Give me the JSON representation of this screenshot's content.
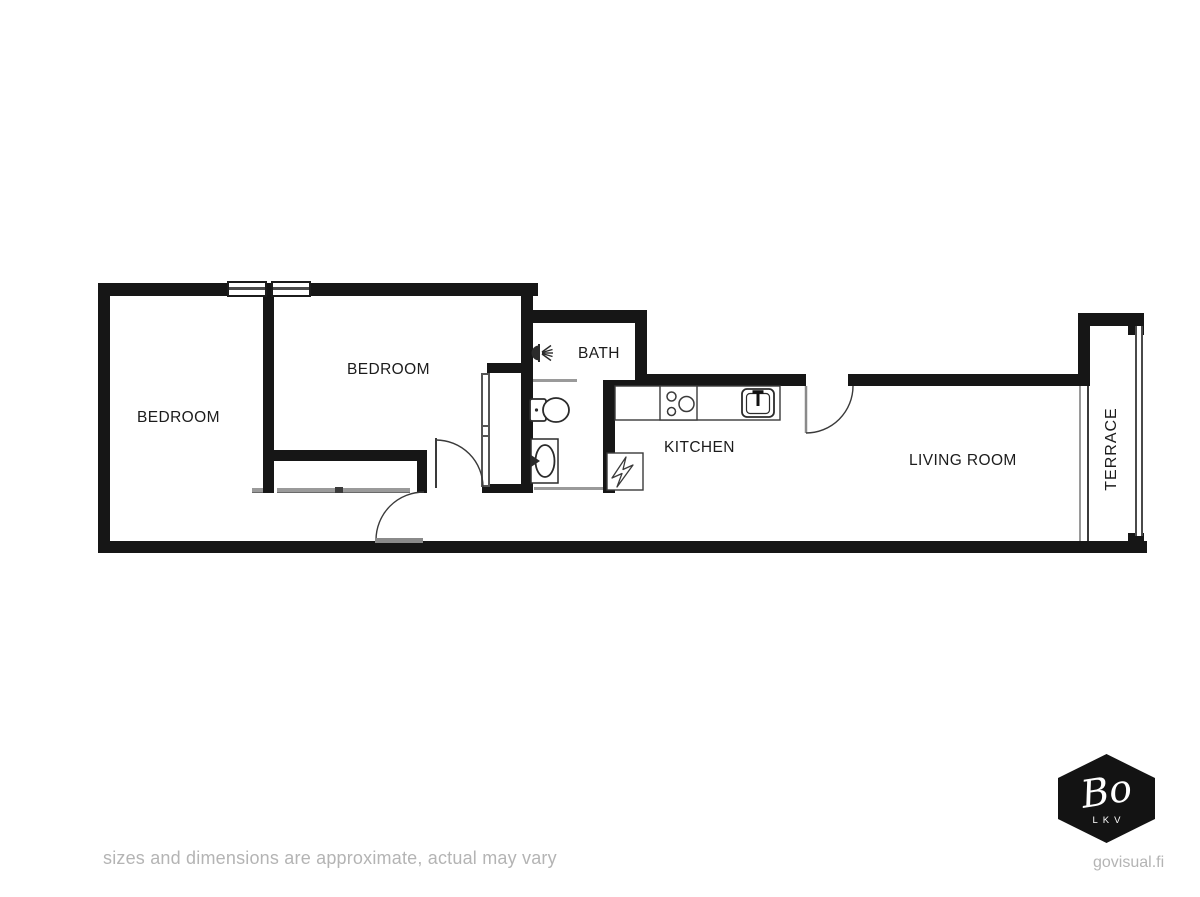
{
  "plan": {
    "rooms": {
      "bedroom1": "BEDROOM",
      "bedroom2": "BEDROOM",
      "bath": "BATH",
      "kitchen": "KITCHEN",
      "living_room": "LIVING ROOM",
      "terrace": "TERRACE"
    },
    "icons": {
      "shower": "shower-head-icon",
      "toilet": "toilet-icon",
      "bath_sink": "washbasin-icon",
      "stove": "stove-burners-icon",
      "kitchen_sink": "kitchen-sink-faucet-icon",
      "electrical": "electrical-panel-lightning-icon",
      "doors": "door-swing-arc",
      "windows": "window-symbol",
      "closet": "closet-sliding-front",
      "wardrobe": "wardrobe-unit"
    },
    "colors": {
      "wall": "#161616",
      "label": "#1c1c1c",
      "thin_line": "#9a9a9a",
      "fixture_stroke": "#2b2b2b",
      "muted_text": "#b4b4b4",
      "background": "#ffffff",
      "logo_bg": "#131313",
      "logo_text": "#ffffff"
    }
  },
  "footer": {
    "disclaimer": "sizes and dimensions are approximate, actual may vary",
    "website": "govisual.fi"
  },
  "logo": {
    "brand": "Bo",
    "sub": "LKV"
  }
}
